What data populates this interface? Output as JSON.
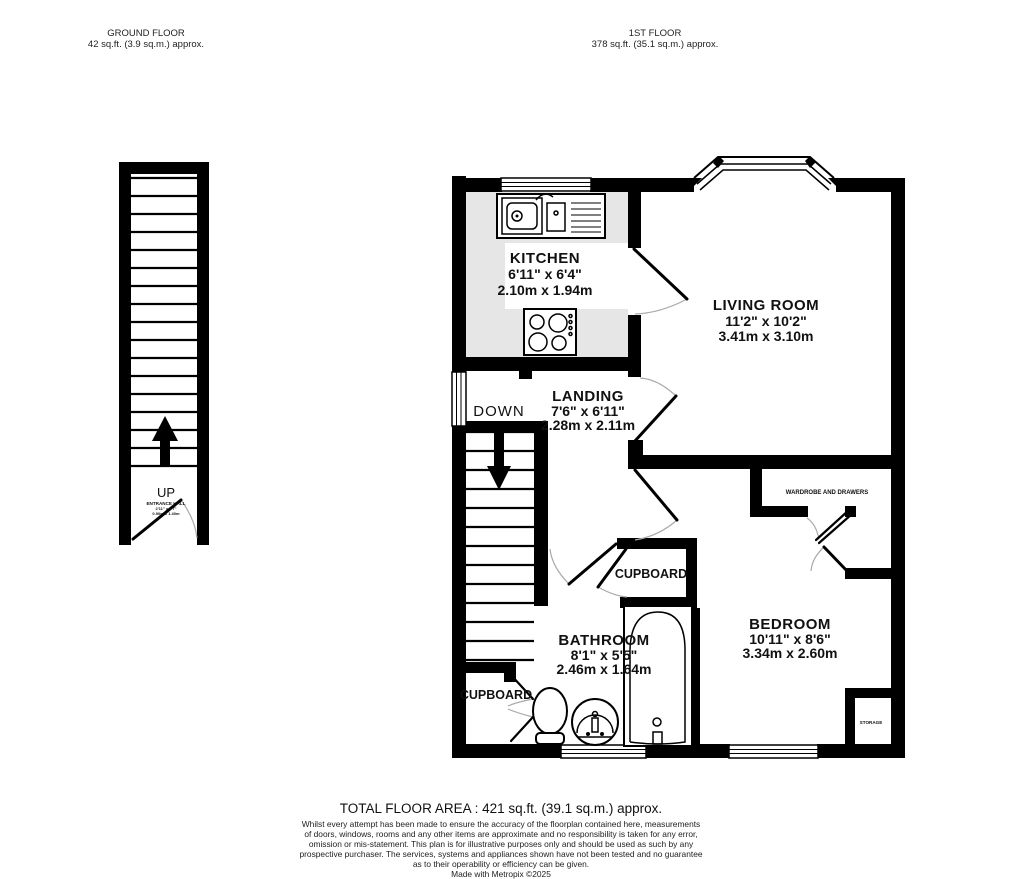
{
  "header": {
    "ground_floor": {
      "title": "GROUND FLOOR",
      "area": "42 sq.ft. (3.9 sq.m.) approx."
    },
    "first_floor": {
      "title": "1ST FLOOR",
      "area": "378 sq.ft. (35.1 sq.m.) approx."
    }
  },
  "ground_floor": {
    "stairs_label": "UP",
    "entrance_hall": {
      "name": "ENTRANCE HALL",
      "imperial": "2'11\" x 4'7\"",
      "metric": "0.90m x 1.40m"
    }
  },
  "first_floor": {
    "stairs_label": "DOWN",
    "kitchen": {
      "name": "KITCHEN",
      "imperial": "6'11\" x 6'4\"",
      "metric": "2.10m x 1.94m"
    },
    "living_room": {
      "name": "LIVING ROOM",
      "imperial": "11'2\" x 10'2\"",
      "metric": "3.41m x 3.10m"
    },
    "landing": {
      "name": "LANDING",
      "imperial": "7'6\" x 6'11\"",
      "metric": "2.28m x 2.11m"
    },
    "bathroom": {
      "name": "BATHROOM",
      "imperial": "8'1\" x 5'5\"",
      "metric": "2.46m x 1.64m"
    },
    "bedroom": {
      "name": "BEDROOM",
      "imperial": "10'11\" x 8'6\"",
      "metric": "3.34m x 2.60m"
    },
    "wardrobe_label": "WARDROBE AND DRAWERS",
    "cupboard_label": "CUPBOARD",
    "under_stairs_cupboard_label": "CUPBOARD",
    "storage_label": "STORAGE"
  },
  "footer": {
    "total_area": "TOTAL FLOOR AREA : 421 sq.ft. (39.1 sq.m.) approx.",
    "disclaimer": [
      "Whilst every attempt has been made to ensure the accuracy of the floorplan contained here, measurements",
      "of doors, windows, rooms and any other items are approximate and no responsibility is taken for any error,",
      "omission or mis-statement. This plan is for illustrative purposes only and should be used as such by any",
      "prospective purchaser. The services, systems and appliances shown have not been tested and no guarantee",
      "as to their operability or efficiency can be given."
    ],
    "credit": "Made with Metropix ©2025"
  },
  "colors": {
    "wall": "#000000",
    "counter": "#e6e6e6",
    "background": "#ffffff",
    "door_arc": "#aaaaaa"
  }
}
